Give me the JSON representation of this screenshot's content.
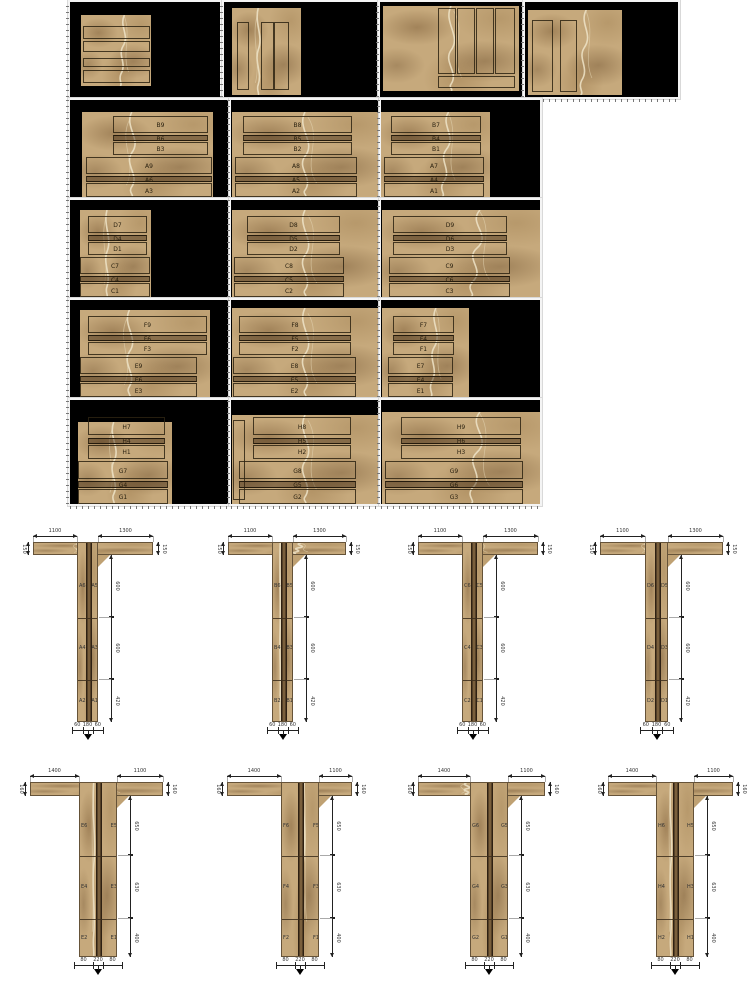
{
  "palette": {
    "page_background": "#ffffff",
    "slab_background": "#000000",
    "marble_base": "#c6a97c",
    "marble_vein": "#efe4c8",
    "cut_outline": "#2d2312",
    "dimension_color": "#222222"
  },
  "slab_rows": [
    {
      "panels": [
        {
          "description": "horizontal-strips",
          "labels": []
        },
        {
          "description": "vertical-strips",
          "labels": []
        },
        {
          "description": "vertical-strips-with-bottom-strip",
          "labels": []
        },
        {
          "description": "vertical-strips",
          "labels": []
        }
      ]
    },
    {
      "panels": [
        {
          "labels": [
            "B9",
            "B6",
            "B3",
            "A9",
            "A6",
            "A3"
          ]
        },
        {
          "labels": [
            "B8",
            "B5",
            "B2",
            "A8",
            "A5",
            "A2"
          ]
        },
        {
          "labels": [
            "B7",
            "B4",
            "B1",
            "A7",
            "A4",
            "A1"
          ]
        }
      ]
    },
    {
      "panels": [
        {
          "labels": [
            "D7",
            "D4",
            "D1",
            "C7",
            "C4",
            "C1"
          ]
        },
        {
          "labels": [
            "D8",
            "D5",
            "D2",
            "C8",
            "C5",
            "C2"
          ]
        },
        {
          "labels": [
            "D9",
            "D6",
            "D3",
            "C9",
            "C6",
            "C3"
          ]
        }
      ]
    },
    {
      "panels": [
        {
          "labels": [
            "F9",
            "F6",
            "F3",
            "E9",
            "E6",
            "E3"
          ]
        },
        {
          "labels": [
            "F8",
            "F5",
            "F2",
            "E8",
            "E5",
            "E2"
          ]
        },
        {
          "labels": [
            "F7",
            "F4",
            "F1",
            "E7",
            "E4",
            "E1"
          ]
        }
      ]
    },
    {
      "panels": [
        {
          "labels": [
            "H7",
            "H4",
            "H1",
            "G7",
            "G4",
            "G1"
          ]
        },
        {
          "labels": [
            "H8",
            "H5",
            "H2",
            "G8",
            "G5",
            "G2"
          ]
        },
        {
          "labels": [
            "H9",
            "H6",
            "H3",
            "G9",
            "G6",
            "G3"
          ]
        }
      ]
    }
  ],
  "t_rows": [
    {
      "sections": [
        {
          "top_left_dim": "1100",
          "top_right_dim": "1300",
          "flange_end_dim": "150",
          "stem_segment_dims": [
            "600",
            "600",
            "420"
          ],
          "bottom_dims": [
            "60",
            "180",
            "60"
          ],
          "segment_piece_labels": [
            [
              "A6",
              "A5"
            ],
            [
              "A4",
              "A3"
            ],
            [
              "A2",
              "A1"
            ]
          ]
        },
        {
          "top_left_dim": "1100",
          "top_right_dim": "1300",
          "flange_end_dim": "150",
          "stem_segment_dims": [
            "600",
            "600",
            "420"
          ],
          "bottom_dims": [
            "60",
            "180",
            "60"
          ],
          "segment_piece_labels": [
            [
              "B6",
              "B5"
            ],
            [
              "B4",
              "B3"
            ],
            [
              "B2",
              "B1"
            ]
          ]
        },
        {
          "top_left_dim": "1100",
          "top_right_dim": "1300",
          "flange_end_dim": "150",
          "stem_segment_dims": [
            "600",
            "600",
            "420"
          ],
          "bottom_dims": [
            "60",
            "180",
            "60"
          ],
          "segment_piece_labels": [
            [
              "C6",
              "C5"
            ],
            [
              "C4",
              "C3"
            ],
            [
              "C2",
              "C1"
            ]
          ]
        },
        {
          "top_left_dim": "1100",
          "top_right_dim": "1300",
          "flange_end_dim": "150",
          "stem_segment_dims": [
            "600",
            "600",
            "420"
          ],
          "bottom_dims": [
            "60",
            "180",
            "60"
          ],
          "segment_piece_labels": [
            [
              "D6",
              "D5"
            ],
            [
              "D4",
              "D3"
            ],
            [
              "D2",
              "D1"
            ]
          ]
        }
      ]
    },
    {
      "sections": [
        {
          "top_left_dim": "1400",
          "top_right_dim": "1100",
          "flange_end_dim": "160",
          "stem_segment_dims": [
            "650",
            "630",
            "400"
          ],
          "bottom_dims": [
            "80",
            "220",
            "80"
          ],
          "segment_piece_labels": [
            [
              "E6",
              "E5"
            ],
            [
              "E4",
              "E3"
            ],
            [
              "E2",
              "E1"
            ]
          ]
        },
        {
          "top_left_dim": "1400",
          "top_right_dim": "1100",
          "flange_end_dim": "160",
          "stem_segment_dims": [
            "650",
            "630",
            "400"
          ],
          "bottom_dims": [
            "80",
            "220",
            "80"
          ],
          "segment_piece_labels": [
            [
              "F6",
              "F5"
            ],
            [
              "F4",
              "F3"
            ],
            [
              "F2",
              "F1"
            ]
          ]
        },
        {
          "top_left_dim": "1400",
          "top_right_dim": "1100",
          "flange_end_dim": "160",
          "stem_segment_dims": [
            "650",
            "630",
            "400"
          ],
          "bottom_dims": [
            "80",
            "220",
            "80"
          ],
          "segment_piece_labels": [
            [
              "G6",
              "G5"
            ],
            [
              "G4",
              "G3"
            ],
            [
              "G2",
              "G1"
            ]
          ]
        },
        {
          "top_left_dim": "1400",
          "top_right_dim": "1100",
          "flange_end_dim": "160",
          "stem_segment_dims": [
            "650",
            "630",
            "400"
          ],
          "bottom_dims": [
            "80",
            "220",
            "80"
          ],
          "segment_piece_labels": [
            [
              "H6",
              "H5"
            ],
            [
              "H4",
              "H3"
            ],
            [
              "H2",
              "H1"
            ]
          ]
        }
      ]
    }
  ]
}
